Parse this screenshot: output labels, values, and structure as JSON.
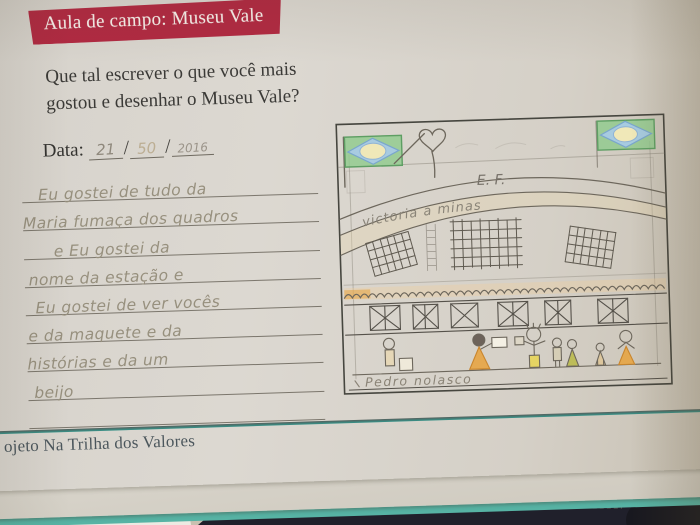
{
  "page": {
    "banner": {
      "label": "Aula de campo: Museu Vale"
    },
    "question": {
      "line1": "Que tal escrever o que você mais",
      "line2": "gostou e desenhar o Museu Vale?"
    },
    "date": {
      "label": "Data:",
      "day": "21",
      "month": "50",
      "year": "2016",
      "separator": "/"
    },
    "essay": {
      "lines": [
        "Eu gostei de tudo da",
        "Maria fumaça dos quadros",
        "e Eu gostei da",
        "nome da estação e",
        "Eu gostei de ver vocês",
        "e da maquete e da",
        "histórias e da um",
        "beijo",
        ""
      ]
    },
    "drawing": {
      "building_sign": "E. F.",
      "arch_text": "victoria a minas",
      "caption": "Pedro nolasco",
      "icons": [
        "brazil-flag-icon",
        "brazil-flag-icon",
        "heart-icon"
      ]
    },
    "footer": {
      "label": "ojeto Na Trilha dos Valores"
    }
  },
  "colors": {
    "banner_bg": "#b12a42",
    "cover_teal": "#35948a",
    "pencil": "#6d675c",
    "crayon_orange": "#e8a23c",
    "flag_green": "#8fca8c",
    "flag_blue": "#a9cbe8"
  }
}
